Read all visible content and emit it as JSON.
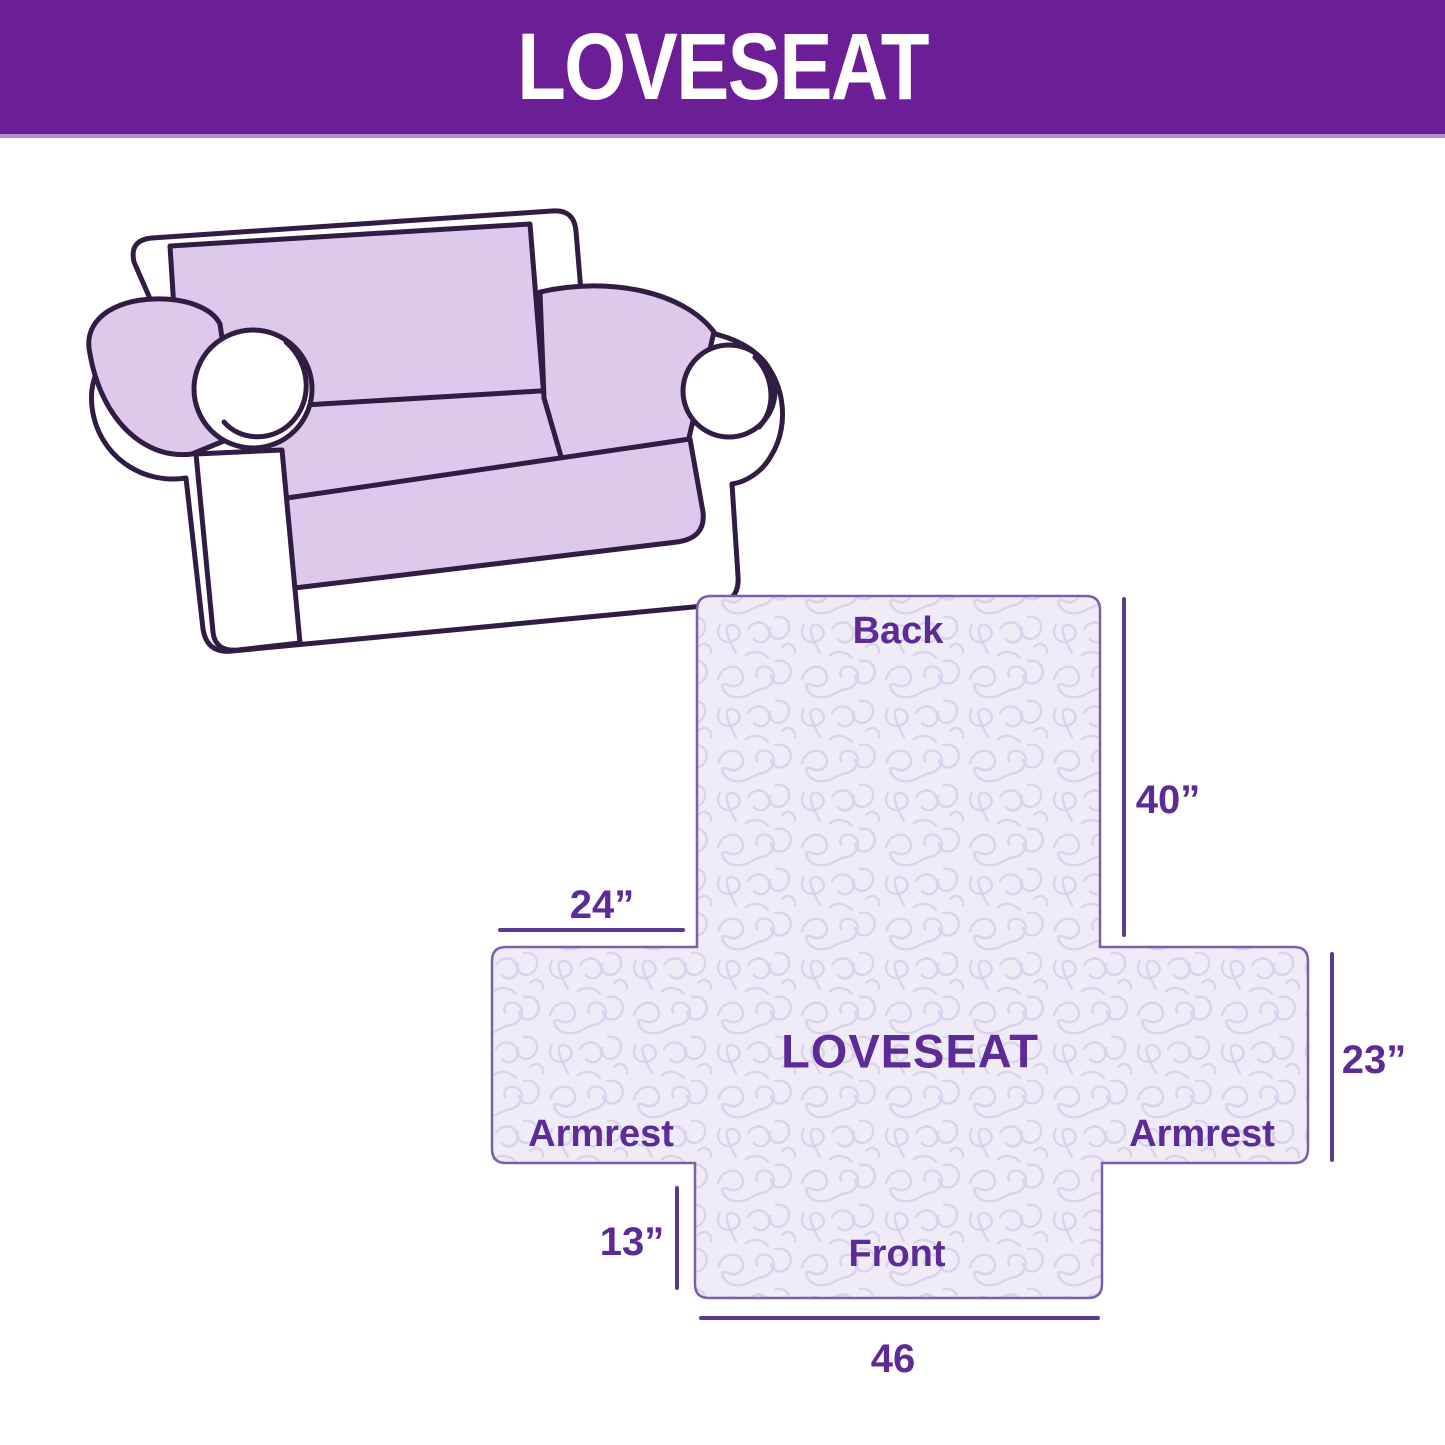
{
  "header": {
    "title": "LOVESEAT"
  },
  "illustration": {
    "description": "Line drawing of a two-seat loveseat wearing a light lavender quilted slipcover on the back, seat cushion and armrest tops"
  },
  "diagram": {
    "section_labels": {
      "back": "Back",
      "center": "LOVESEAT",
      "armrest_left": "Armrest",
      "armrest_right": "Armrest",
      "front": "Front"
    },
    "dimension_labels": {
      "back_height": "40”",
      "armrest_top_width": "24”",
      "armrest_side_height": "23”",
      "front_skirt_height": "13”",
      "front_width": "46"
    },
    "colors": {
      "header_bg": "#6b1e96",
      "header_text": "#ffffff",
      "label_text": "#5c2b96",
      "cover_fill": "#efecf8",
      "quilt_line": "#dad3ec",
      "cover_outline": "#7a5fab",
      "dimension_line": "#5b3a96",
      "sofa_cover": "#dcc9ec",
      "sofa_line": "#311d44"
    }
  }
}
